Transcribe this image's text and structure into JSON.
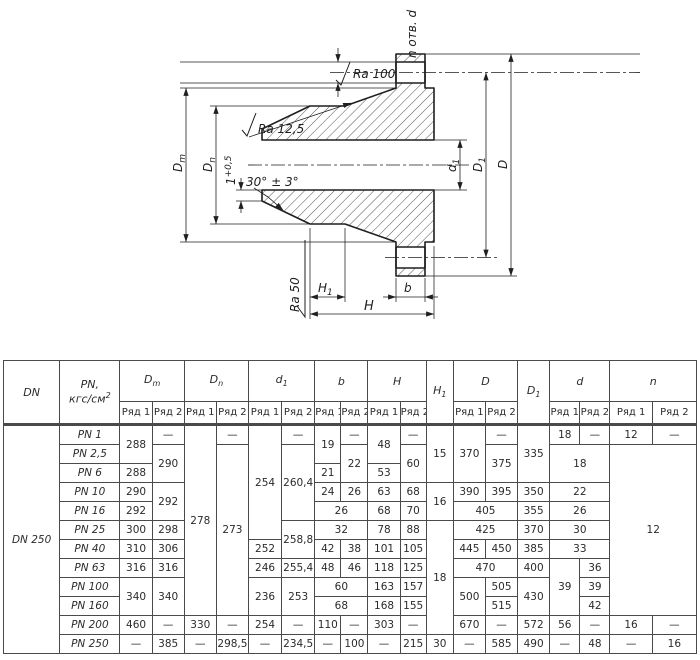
{
  "ink": "#1f1f1f",
  "drawing": {
    "labels": {
      "holes": "n отв. d",
      "ra_hole": "Ra 100",
      "ra_cone": "Ra 12,5",
      "ra_face": "Ra 50",
      "chamfer_angle": "30° ± 3°",
      "land_base": "1",
      "land_sup": "+0,5",
      "dm_base": "D",
      "dm_sub": "m",
      "dn_base": "D",
      "dn_sub": "n",
      "d1_base": "d",
      "d1_sub": "1",
      "dd1_base": "D",
      "dd1_sub": "1",
      "d_outer": "D",
      "h1_base": "H",
      "h1_sub": "1",
      "h": "H",
      "b": "b"
    }
  },
  "table": {
    "col_widths": [
      56,
      60,
      32,
      32,
      32,
      32,
      33,
      33,
      26,
      27,
      32,
      26,
      27,
      32,
      32,
      32,
      30,
      30,
      42,
      44
    ],
    "header": [
      [
        {
          "t": "DN",
          "rs": 2
        },
        {
          "t": "PN,\nкгс/см^{2}",
          "rs": 2
        },
        {
          "t": "D_{m}",
          "cs": 2
        },
        {
          "t": "D_{n}",
          "cs": 2
        },
        {
          "t": "d_{1}",
          "cs": 2
        },
        {
          "t": "b",
          "cs": 2
        },
        {
          "t": "H",
          "cs": 2
        },
        {
          "t": "H_{1}",
          "rs": 2
        },
        {
          "t": "D",
          "cs": 2
        },
        {
          "t": "D_{1}",
          "rs": 2
        },
        {
          "t": "d",
          "cs": 2
        },
        {
          "t": "n",
          "cs": 2
        }
      ],
      [
        {
          "t": "Ряд 1"
        },
        {
          "t": "Ряд 2"
        },
        {
          "t": "Ряд 1"
        },
        {
          "t": "Ряд 2"
        },
        {
          "t": "Ряд 1"
        },
        {
          "t": "Ряд 2"
        },
        {
          "t": "Ряд 1"
        },
        {
          "t": "Ряд 2"
        },
        {
          "t": "Ряд 1"
        },
        {
          "t": "Ряд 2"
        },
        {
          "t": "Ряд 1"
        },
        {
          "t": "Ряд 2"
        },
        {
          "t": "Ряд 1"
        },
        {
          "t": "Ряд 2"
        },
        {
          "t": "Ряд 1"
        },
        {
          "t": "Ряд 2"
        }
      ]
    ],
    "rows": [
      [
        {
          "t": "DN 250",
          "rs": 12,
          "c": "dn"
        },
        {
          "t": "PN 1",
          "c": "pn"
        },
        {
          "t": "288",
          "rs": 2
        },
        {
          "t": "—"
        },
        {
          "t": "278",
          "rs": 10
        },
        {
          "t": "—"
        },
        {
          "t": "254",
          "rs": 6
        },
        {
          "t": "—"
        },
        {
          "t": "19",
          "rs": 2
        },
        {
          "t": "—"
        },
        {
          "t": "48",
          "rs": 2
        },
        {
          "t": "—"
        },
        {
          "t": "15",
          "rs": 3
        },
        {
          "t": "370",
          "rs": 3
        },
        {
          "t": "—"
        },
        {
          "t": "335",
          "rs": 3
        },
        {
          "t": "18"
        },
        {
          "t": "—"
        },
        {
          "t": "12"
        },
        {
          "t": "—"
        }
      ],
      [
        {
          "t": "PN 2,5",
          "c": "pn"
        },
        {
          "t": "290",
          "rs": 2
        },
        {
          "t": "273",
          "rs": 9
        },
        {
          "t": "260,4",
          "rs": 4
        },
        {
          "t": "22",
          "rs": 2
        },
        {
          "t": "60",
          "rs": 2
        },
        {
          "t": "375",
          "rs": 2
        },
        {
          "t": "18",
          "rs": 2,
          "cs": 2
        },
        {
          "t": "12",
          "rs": 9,
          "cs": 2
        }
      ],
      [
        {
          "t": "PN 6",
          "c": "pn"
        },
        {
          "t": "288"
        },
        {
          "t": "21"
        },
        {
          "t": "53"
        }
      ],
      [
        {
          "t": "PN 10",
          "c": "pn"
        },
        {
          "t": "290"
        },
        {
          "t": "292",
          "rs": 2
        },
        {
          "t": "24"
        },
        {
          "t": "26"
        },
        {
          "t": "63"
        },
        {
          "t": "68"
        },
        {
          "t": "16",
          "rs": 2
        },
        {
          "t": "390"
        },
        {
          "t": "395"
        },
        {
          "t": "350"
        },
        {
          "t": "22",
          "cs": 2
        }
      ],
      [
        {
          "t": "PN 16",
          "c": "pn"
        },
        {
          "t": "292"
        },
        {
          "t": "26",
          "cs": 2
        },
        {
          "t": "68"
        },
        {
          "t": "70"
        },
        {
          "t": "405",
          "cs": 2
        },
        {
          "t": "355"
        },
        {
          "t": "26",
          "cs": 2
        }
      ],
      [
        {
          "t": "PN 25",
          "c": "pn"
        },
        {
          "t": "300"
        },
        {
          "t": "298"
        },
        {
          "t": "258,8",
          "rs": 2
        },
        {
          "t": "32",
          "cs": 2
        },
        {
          "t": "78"
        },
        {
          "t": "88"
        },
        {
          "t": "18",
          "rs": 6
        },
        {
          "t": "425",
          "cs": 2
        },
        {
          "t": "370"
        },
        {
          "t": "30",
          "cs": 2
        }
      ],
      [
        {
          "t": "PN 40",
          "c": "pn"
        },
        {
          "t": "310"
        },
        {
          "t": "306"
        },
        {
          "t": "252"
        },
        {
          "t": "42"
        },
        {
          "t": "38"
        },
        {
          "t": "101"
        },
        {
          "t": "105"
        },
        {
          "t": "445"
        },
        {
          "t": "450"
        },
        {
          "t": "385"
        },
        {
          "t": "33",
          "cs": 2
        }
      ],
      [
        {
          "t": "PN 63",
          "c": "pn"
        },
        {
          "t": "316"
        },
        {
          "t": "316"
        },
        {
          "t": "246"
        },
        {
          "t": "255,4"
        },
        {
          "t": "48"
        },
        {
          "t": "46"
        },
        {
          "t": "118"
        },
        {
          "t": "125"
        },
        {
          "t": "470",
          "cs": 2
        },
        {
          "t": "400"
        },
        {
          "t": "39",
          "rs": 3
        },
        {
          "t": "36"
        }
      ],
      [
        {
          "t": "PN 100",
          "c": "pn"
        },
        {
          "t": "340",
          "rs": 2
        },
        {
          "t": "340",
          "rs": 2
        },
        {
          "t": "236",
          "rs": 2
        },
        {
          "t": "253",
          "rs": 2
        },
        {
          "t": "60",
          "cs": 2
        },
        {
          "t": "163"
        },
        {
          "t": "157"
        },
        {
          "t": "500",
          "rs": 2
        },
        {
          "t": "505"
        },
        {
          "t": "430",
          "rs": 2
        },
        {
          "t": "39"
        }
      ],
      [
        {
          "t": "PN 160",
          "c": "pn"
        },
        {
          "t": "68",
          "cs": 2
        },
        {
          "t": "168"
        },
        {
          "t": "155"
        },
        {
          "t": "515"
        },
        {
          "t": "42"
        }
      ],
      [
        {
          "t": "PN 200",
          "c": "pn"
        },
        {
          "t": "460"
        },
        {
          "t": "—"
        },
        {
          "t": "330"
        },
        {
          "t": "—"
        },
        {
          "t": "254"
        },
        {
          "t": "—"
        },
        {
          "t": "110"
        },
        {
          "t": "—"
        },
        {
          "t": "303"
        },
        {
          "t": "—"
        },
        {
          "t": "670"
        },
        {
          "t": "—"
        },
        {
          "t": "572"
        },
        {
          "t": "56"
        },
        {
          "t": "—"
        },
        {
          "t": "16"
        },
        {
          "t": "—"
        }
      ],
      [
        {
          "t": "PN 250",
          "c": "pn"
        },
        {
          "t": "—"
        },
        {
          "t": "385"
        },
        {
          "t": "—"
        },
        {
          "t": "298,5"
        },
        {
          "t": "—"
        },
        {
          "t": "234,5"
        },
        {
          "t": "—"
        },
        {
          "t": "100"
        },
        {
          "t": "—"
        },
        {
          "t": "215"
        },
        {
          "t": "30"
        },
        {
          "t": "—"
        },
        {
          "t": "585"
        },
        {
          "t": "490"
        },
        {
          "t": "—"
        },
        {
          "t": "48"
        },
        {
          "t": "—"
        },
        {
          "t": "16"
        }
      ]
    ]
  }
}
